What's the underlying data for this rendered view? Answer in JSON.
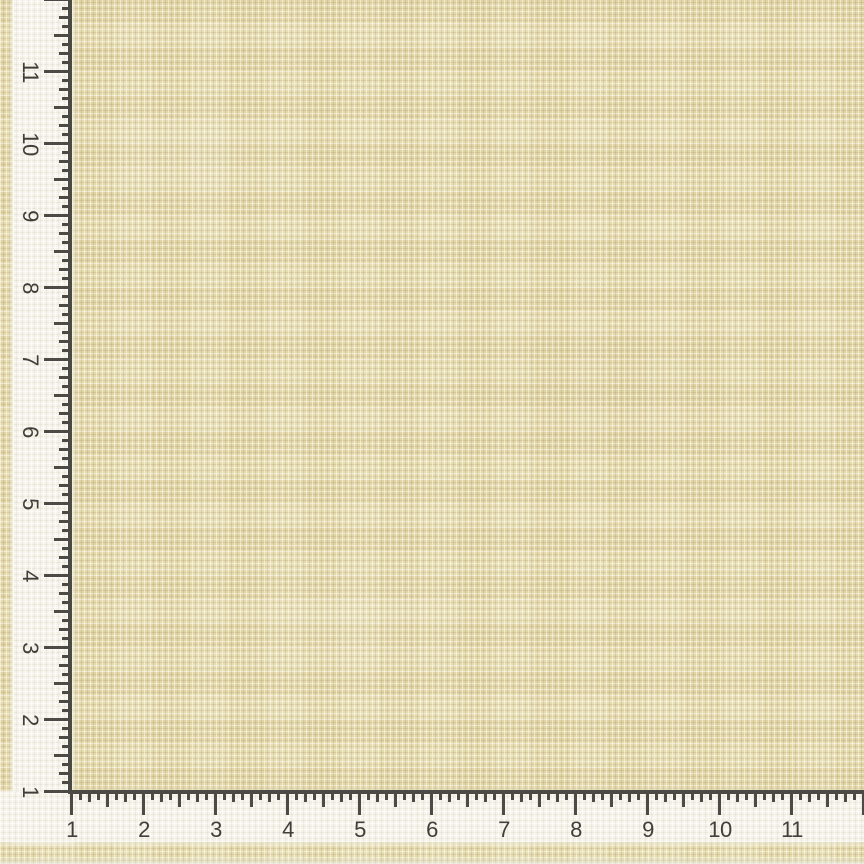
{
  "scene": {
    "description": "Cream burlap fabric swatch photographed with printed measuring ruler strips along the left and bottom edges"
  },
  "fabric": {
    "base_color": "#e6daab",
    "weave_highlight": "#faf6e6",
    "weave_shadow": "#c9ba8c"
  },
  "ruler": {
    "strip_color": "#f5f3ea",
    "line_color": "#4b4a45",
    "tick_color": "#4b4a45",
    "number_color": "#403e38",
    "px_per_unit": 72,
    "subdivisions_per_unit": 8,
    "vertical": {
      "side": "left",
      "numbers": [
        "1",
        "2",
        "3",
        "4",
        "5",
        "6",
        "7",
        "8",
        "9",
        "10",
        "11"
      ],
      "number_rotation_deg": 90
    },
    "horizontal": {
      "side": "bottom",
      "numbers": [
        "1",
        "2",
        "3",
        "4",
        "5",
        "6",
        "7",
        "8",
        "9",
        "10",
        "11"
      ]
    }
  }
}
